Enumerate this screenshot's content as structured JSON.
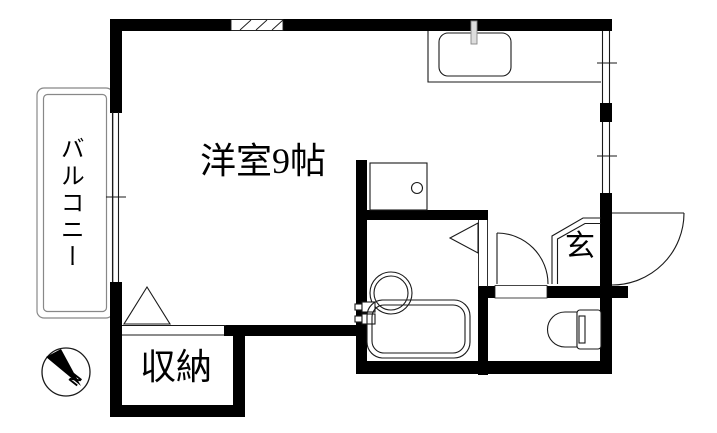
{
  "page": {
    "type": "apartment-floor-plan"
  },
  "colors": {
    "bg": "#ffffff",
    "wall": "#000000",
    "ink": "#1a1a1a",
    "soft": "#888888",
    "fixture": "#dddddd"
  },
  "labels": {
    "room": "洋室9帖",
    "balcony": "バルコニー",
    "storage": "収納",
    "entrance": "玄",
    "compass_north": "N"
  }
}
